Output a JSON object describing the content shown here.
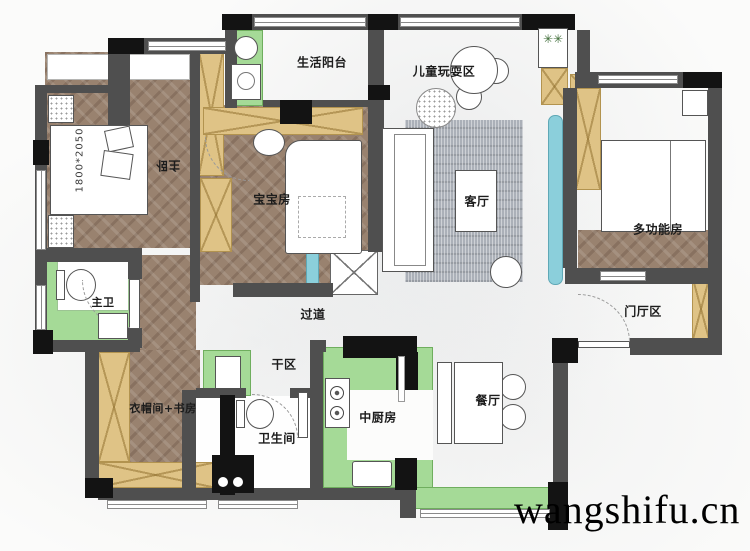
{
  "watermark": "wangshifu.cn",
  "rooms": {
    "master_bedroom": {
      "label": "主卧"
    },
    "life_balcony": {
      "label": "生活阳台"
    },
    "kids_play_area": {
      "label": "儿童玩耍区"
    },
    "baby_room": {
      "label": "宝宝房"
    },
    "living_room": {
      "label": "客厅"
    },
    "multi_function_room": {
      "label": "多功能房"
    },
    "master_bathroom": {
      "label": "主卫"
    },
    "hallway": {
      "label": "过道"
    },
    "entry_hall": {
      "label": "门厅区"
    },
    "cloakroom_study": {
      "label": "衣帽间+书房"
    },
    "dry_area": {
      "label": "干区"
    },
    "bathroom": {
      "label": "卫生间"
    },
    "chinese_kitchen": {
      "label": "中厨房"
    },
    "dining_room": {
      "label": "餐厅"
    }
  },
  "annotations": {
    "master_bed_size": "1800*2050"
  },
  "icons": {
    "plant": "✳✳"
  },
  "colors": {
    "wall": "#4f4f4f",
    "column": "#131313",
    "wood_floor": "#99826f",
    "cabinet": "#dfc386",
    "green_floor": "#a5da97",
    "teal_accent": "#8bcfdb",
    "rug": "#abb0b8",
    "marble": "#fbfbfa"
  }
}
